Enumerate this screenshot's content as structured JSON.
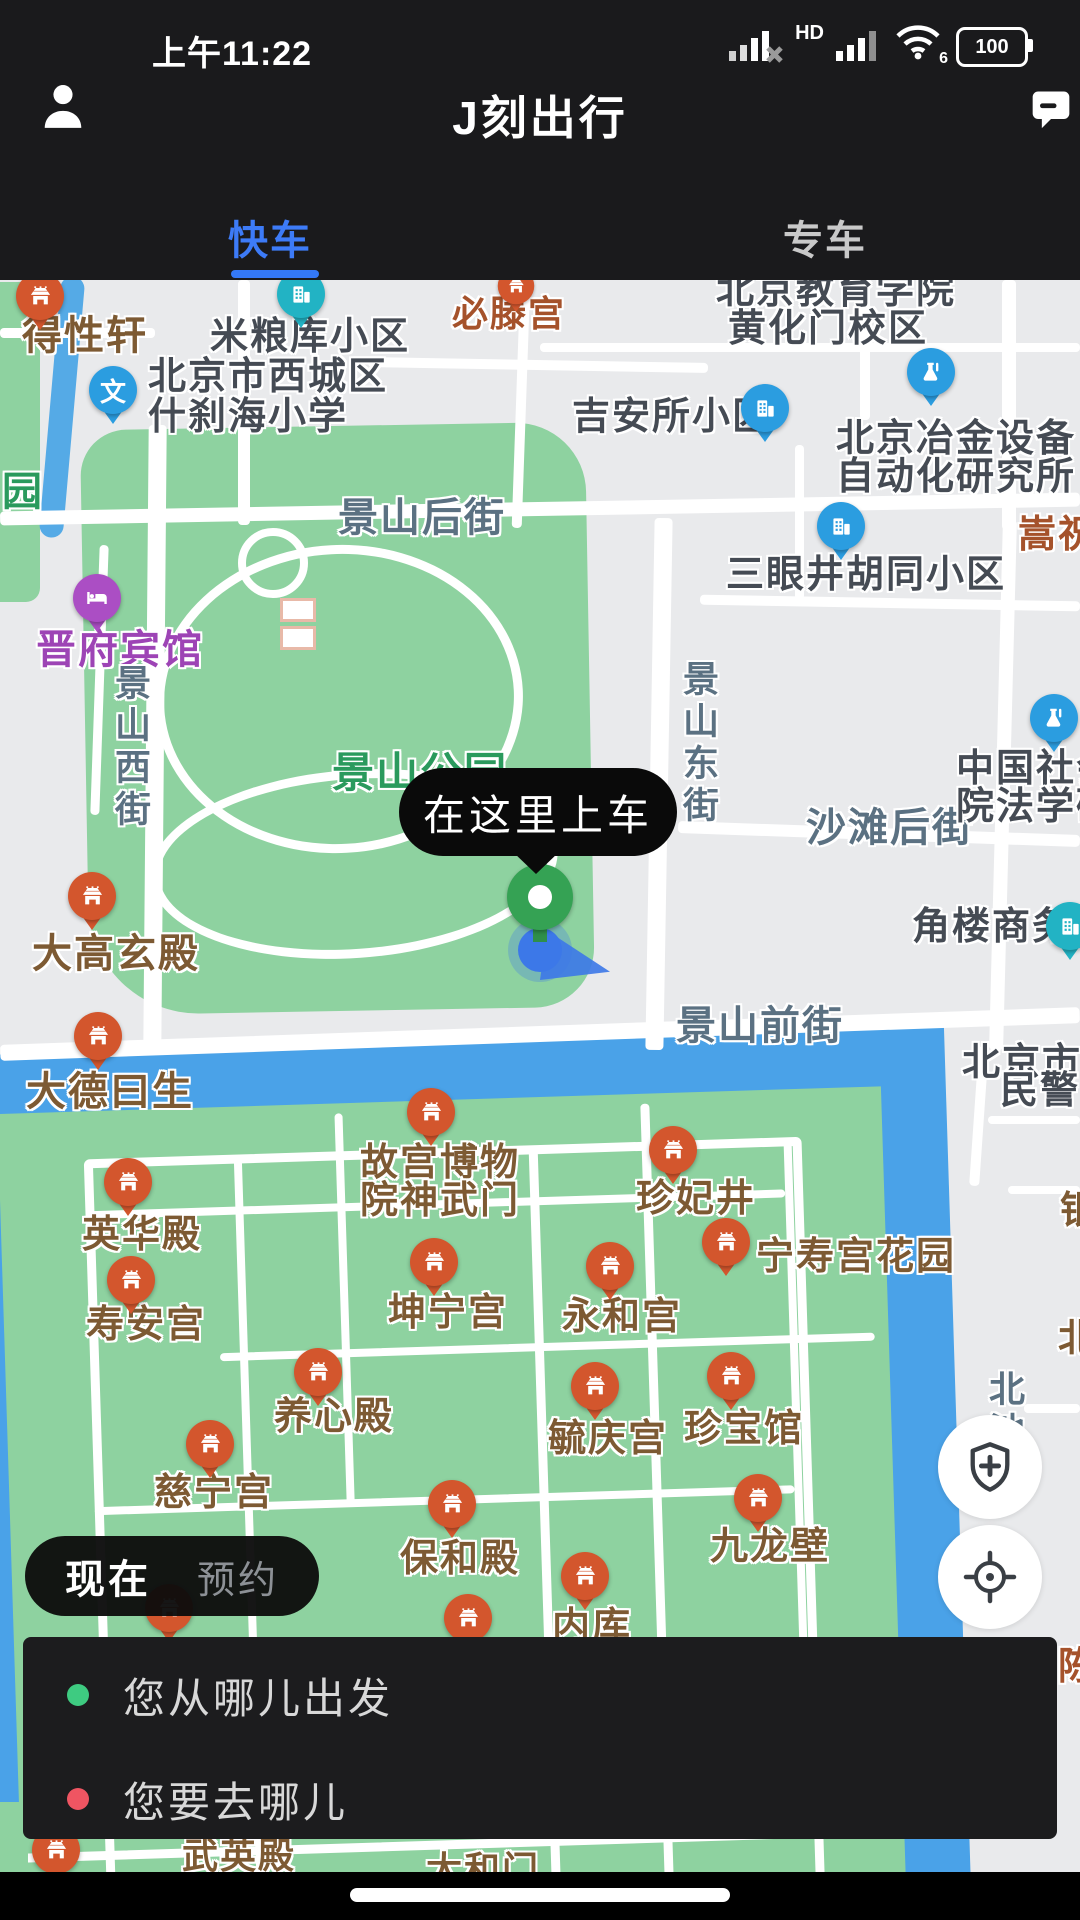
{
  "status_bar": {
    "time": "上午11:22",
    "hd_label": "HD",
    "wifi_badge": "6",
    "battery_level": "100"
  },
  "header": {
    "title": "J刻出行"
  },
  "tabs": {
    "items": [
      {
        "label": "快车"
      },
      {
        "label": "专车"
      }
    ],
    "active_index": 0
  },
  "map": {
    "pickup_callout": "在这里上车",
    "labels": [
      {
        "text": "得性轩",
        "x": 22,
        "y": 316,
        "type": "palace",
        "fs": 40
      },
      {
        "text": "米粮库小区",
        "x": 210,
        "y": 318,
        "type": "poi"
      },
      {
        "text": "北京市西城区",
        "x": 148,
        "y": 358,
        "type": "poi"
      },
      {
        "text": "什刹海小学",
        "x": 148,
        "y": 398,
        "type": "poi"
      },
      {
        "text": "必滕宫",
        "x": 452,
        "y": 296,
        "type": "redbrown",
        "fs": 36
      },
      {
        "text": "北京教育学院",
        "x": 716,
        "y": 272,
        "type": "poi"
      },
      {
        "text": "黄化门校区",
        "x": 728,
        "y": 310,
        "type": "poi"
      },
      {
        "text": "吉安所小区",
        "x": 572,
        "y": 398,
        "type": "poi"
      },
      {
        "text": "北京冶金设备",
        "x": 836,
        "y": 420,
        "type": "poi"
      },
      {
        "text": "自动化研究所",
        "x": 836,
        "y": 458,
        "type": "poi"
      },
      {
        "text": "三眼井胡同小区",
        "x": 726,
        "y": 556,
        "type": "poi"
      },
      {
        "text": "嵩祝寺",
        "x": 1018,
        "y": 516,
        "type": "redbrown",
        "fs": 38
      },
      {
        "text": "景山后街",
        "x": 338,
        "y": 498,
        "type": "street",
        "fs": 40
      },
      {
        "text": "园",
        "x": 2,
        "y": 472,
        "type": "green",
        "fs": 40
      },
      {
        "text": "晋府宾馆",
        "x": 36,
        "y": 630,
        "type": "purple",
        "fs": 40
      },
      {
        "text": "景山西街",
        "x": 112,
        "y": 664,
        "type": "street",
        "vert": true,
        "fs": 36
      },
      {
        "text": "景山东街",
        "x": 680,
        "y": 660,
        "type": "street",
        "vert": true,
        "fs": 36
      },
      {
        "text": "景山公园",
        "x": 332,
        "y": 752,
        "type": "green",
        "fs": 42
      },
      {
        "text": "沙滩后街",
        "x": 806,
        "y": 808,
        "type": "street",
        "fs": 40
      },
      {
        "text": "中国社会",
        "x": 956,
        "y": 750,
        "type": "poi"
      },
      {
        "text": "院法学研",
        "x": 956,
        "y": 788,
        "type": "poi"
      },
      {
        "text": "角楼商务",
        "x": 912,
        "y": 908,
        "type": "poi"
      },
      {
        "text": "大高玄殿",
        "x": 32,
        "y": 934,
        "type": "palace",
        "fs": 40
      },
      {
        "text": "景山前街",
        "x": 676,
        "y": 1006,
        "type": "street",
        "fs": 40
      },
      {
        "text": "北京市公",
        "x": 962,
        "y": 1044,
        "type": "poi"
      },
      {
        "text": "民警门",
        "x": 1000,
        "y": 1072,
        "type": "poi"
      },
      {
        "text": "大德曰生",
        "x": 26,
        "y": 1072,
        "type": "palace",
        "fs": 40
      },
      {
        "text": "故宫博物",
        "x": 360,
        "y": 1144,
        "type": "palace"
      },
      {
        "text": "院神武门",
        "x": 360,
        "y": 1182,
        "type": "palace"
      },
      {
        "text": "珍妃井",
        "x": 636,
        "y": 1180,
        "type": "palace"
      },
      {
        "text": "银",
        "x": 1060,
        "y": 1192,
        "type": "palace",
        "fs": 38
      },
      {
        "text": "英华殿",
        "x": 82,
        "y": 1216,
        "type": "palace"
      },
      {
        "text": "宁寿宫花园",
        "x": 756,
        "y": 1238,
        "type": "palace"
      },
      {
        "text": "坤宁宫",
        "x": 388,
        "y": 1294,
        "type": "palace"
      },
      {
        "text": "永和宫",
        "x": 562,
        "y": 1298,
        "type": "palace"
      },
      {
        "text": "寿安宫",
        "x": 86,
        "y": 1306,
        "type": "palace"
      },
      {
        "text": "北",
        "x": 1058,
        "y": 1320,
        "type": "palace",
        "fs": 38
      },
      {
        "text": "北池",
        "x": 986,
        "y": 1370,
        "type": "street",
        "vert": true,
        "fs": 36
      },
      {
        "text": "养心殿",
        "x": 274,
        "y": 1398,
        "type": "palace"
      },
      {
        "text": "珍宝馆",
        "x": 684,
        "y": 1410,
        "type": "palace"
      },
      {
        "text": "毓庆宫",
        "x": 548,
        "y": 1420,
        "type": "palace"
      },
      {
        "text": "慈宁宫",
        "x": 154,
        "y": 1474,
        "type": "palace"
      },
      {
        "text": "保和殿",
        "x": 400,
        "y": 1540,
        "type": "palace"
      },
      {
        "text": "九龙壁",
        "x": 710,
        "y": 1528,
        "type": "palace"
      },
      {
        "text": "内库",
        "x": 552,
        "y": 1608,
        "type": "palace"
      },
      {
        "text": "陈",
        "x": 1058,
        "y": 1648,
        "type": "redbrown",
        "fs": 38
      },
      {
        "text": "武英殿",
        "x": 182,
        "y": 1838,
        "type": "palace",
        "fs": 36
      },
      {
        "text": "太和门",
        "x": 426,
        "y": 1852,
        "type": "palace",
        "fs": 36
      }
    ],
    "pins": [
      {
        "type": "temple",
        "x": 40,
        "y": 296
      },
      {
        "type": "temple",
        "x": 516,
        "y": 286,
        "small": true
      },
      {
        "type": "bteal",
        "x": 301,
        "y": 294
      },
      {
        "type": "wen",
        "x": 113,
        "y": 390
      },
      {
        "type": "bblue",
        "x": 765,
        "y": 408
      },
      {
        "type": "flask",
        "x": 931,
        "y": 372
      },
      {
        "type": "bblue",
        "x": 841,
        "y": 526
      },
      {
        "type": "hotel",
        "x": 97,
        "y": 598
      },
      {
        "type": "flask",
        "x": 1054,
        "y": 718
      },
      {
        "type": "temple",
        "x": 92,
        "y": 896
      },
      {
        "type": "bteal",
        "x": 1070,
        "y": 926
      },
      {
        "type": "temple",
        "x": 98,
        "y": 1036
      },
      {
        "type": "temple",
        "x": 431,
        "y": 1112
      },
      {
        "type": "temple",
        "x": 673,
        "y": 1150
      },
      {
        "type": "temple",
        "x": 128,
        "y": 1182
      },
      {
        "type": "temple",
        "x": 726,
        "y": 1242
      },
      {
        "type": "temple",
        "x": 434,
        "y": 1262
      },
      {
        "type": "temple",
        "x": 610,
        "y": 1266
      },
      {
        "type": "temple",
        "x": 131,
        "y": 1280
      },
      {
        "type": "temple",
        "x": 318,
        "y": 1372
      },
      {
        "type": "temple",
        "x": 731,
        "y": 1376
      },
      {
        "type": "temple",
        "x": 595,
        "y": 1386
      },
      {
        "type": "temple",
        "x": 210,
        "y": 1444
      },
      {
        "type": "temple",
        "x": 452,
        "y": 1504
      },
      {
        "type": "temple",
        "x": 758,
        "y": 1498
      },
      {
        "type": "temple",
        "x": 585,
        "y": 1576
      },
      {
        "type": "temple",
        "x": 169,
        "y": 1608
      },
      {
        "type": "temple",
        "x": 468,
        "y": 1618
      },
      {
        "type": "temple",
        "x": 56,
        "y": 1850
      }
    ]
  },
  "ride_time_toggle": {
    "now": "现在",
    "reserve": "预约"
  },
  "search_panel": {
    "origin_placeholder": "您从哪儿出发",
    "destination_placeholder": "您要去哪儿"
  },
  "colors": {
    "accent_blue": "#3478f6",
    "map_green": "#8ed2a0",
    "water_blue": "#4aa2e8",
    "pin_orange": "#d3562d",
    "origin_dot": "#3ecb81",
    "destination_dot": "#ef5562"
  }
}
